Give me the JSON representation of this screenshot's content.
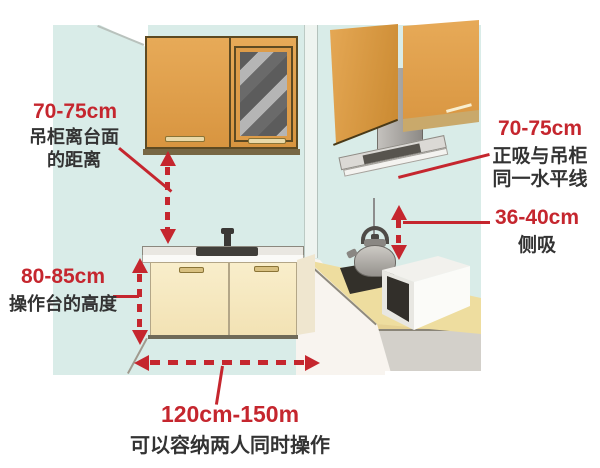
{
  "colors": {
    "accent_red": "#c5262e",
    "wall_teal": "#d9ece8",
    "cabinet_wood": "#dfa04c",
    "base_cabinet_cream": "#f6ebc5",
    "right_counter_beige": "#eedd9f",
    "hood_gray": "#aaa7a3",
    "text_dark": "#333333"
  },
  "annotations": {
    "cabinet_to_counter": {
      "value": "70-75cm",
      "desc_line1": "吊柜离台面",
      "desc_line2": "的距离"
    },
    "counter_height": {
      "value": "80-85cm",
      "desc": "操作台的高度"
    },
    "front_hood": {
      "value": "70-75cm",
      "desc_line1": "正吸与吊柜",
      "desc_line2": "同一水平线"
    },
    "side_hood": {
      "value": "36-40cm",
      "desc": "侧吸"
    },
    "walkway_width": {
      "value": "120cm-150m",
      "desc": "可以容纳两人同时操作"
    }
  }
}
